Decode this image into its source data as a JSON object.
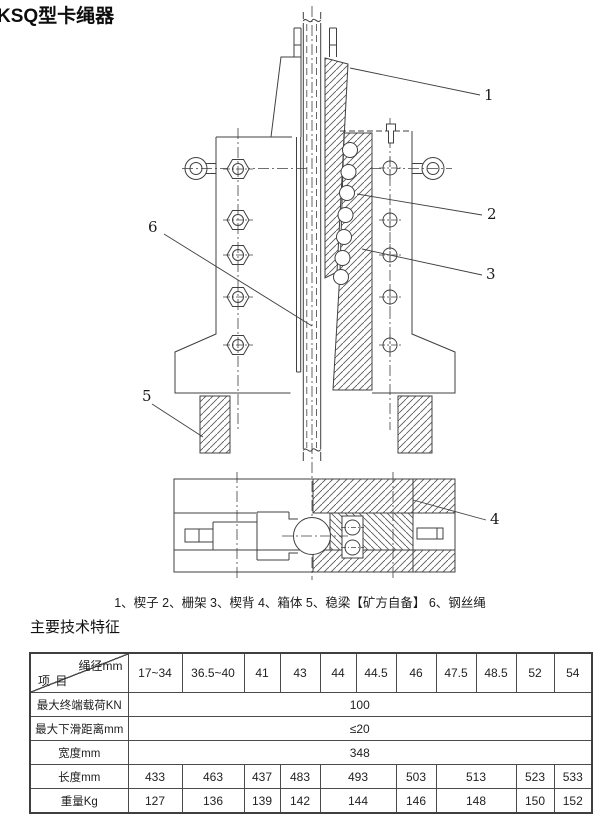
{
  "page": {
    "title": "KSQ型卡绳器"
  },
  "drawing": {
    "caption": "1、楔子 2、栅架 3、楔背 4、箱体 5、稳梁【矿方自备】 6、钢丝绳",
    "callouts": [
      {
        "label": "1"
      },
      {
        "label": "2"
      },
      {
        "label": "3"
      },
      {
        "label": "4"
      },
      {
        "label": "5"
      },
      {
        "label": "6"
      }
    ]
  },
  "section": {
    "title": "主要技术特征"
  },
  "table": {
    "corner": {
      "top_right": "绳径mm",
      "bottom_left": "项 目"
    },
    "columns": [
      "17~34",
      "36.5~40",
      "41",
      "43",
      "44",
      "44.5",
      "46",
      "47.5",
      "48.5",
      "52",
      "54"
    ],
    "rows": [
      {
        "label": "最大终端载荷KN",
        "cells": [
          {
            "text": "100",
            "colspan": 11
          }
        ]
      },
      {
        "label": "最大下滑距离mm",
        "cells": [
          {
            "text": "≤20",
            "colspan": 11
          }
        ]
      },
      {
        "label": "宽度mm",
        "cells": [
          {
            "text": "348",
            "colspan": 11
          }
        ]
      },
      {
        "label": "长度mm",
        "cells": [
          {
            "text": "433"
          },
          {
            "text": "463"
          },
          {
            "text": "437"
          },
          {
            "text": "483"
          },
          {
            "text": "493",
            "colspan": 2
          },
          {
            "text": "503"
          },
          {
            "text": "513",
            "colspan": 2
          },
          {
            "text": "523"
          },
          {
            "text": "533"
          }
        ]
      },
      {
        "label": "重量Kg",
        "cells": [
          {
            "text": "127"
          },
          {
            "text": "136"
          },
          {
            "text": "139"
          },
          {
            "text": "142"
          },
          {
            "text": "144",
            "colspan": 2
          },
          {
            "text": "146"
          },
          {
            "text": "148",
            "colspan": 2
          },
          {
            "text": "150"
          },
          {
            "text": "152"
          }
        ]
      }
    ]
  }
}
